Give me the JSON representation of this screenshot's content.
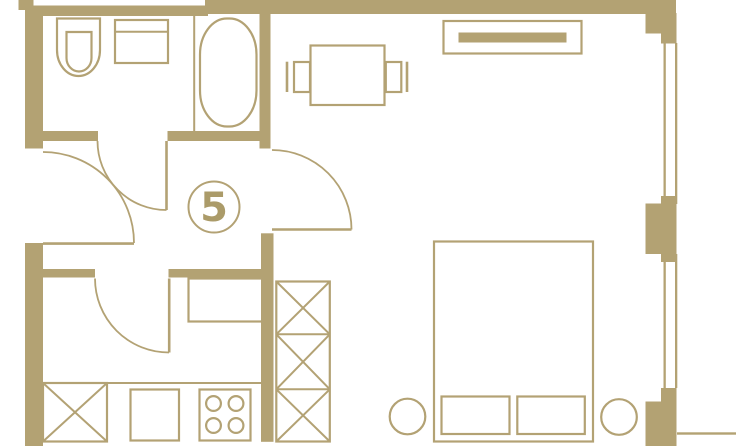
{
  "unit": {
    "label": "5"
  },
  "colors": {
    "background": "#ffffff",
    "wall": "#b3a273",
    "line": "#b3a274",
    "digit": "#ab9b69"
  },
  "symbols": {
    "bathroom": [
      "toilet",
      "sink-unit",
      "bathtub",
      "bathroom-door"
    ],
    "hallway": [
      "unit-number-badge",
      "entrance-door",
      "interior-door"
    ],
    "kitchen": [
      "kitchen-door",
      "counter-fridge",
      "washing-machine",
      "base-cabinet",
      "stove-4-burners"
    ],
    "living-room": [
      "dining-table",
      "chair",
      "dresser",
      "wardrobe-shelving",
      "bed",
      "pillows",
      "nightstands",
      "windows"
    ]
  }
}
